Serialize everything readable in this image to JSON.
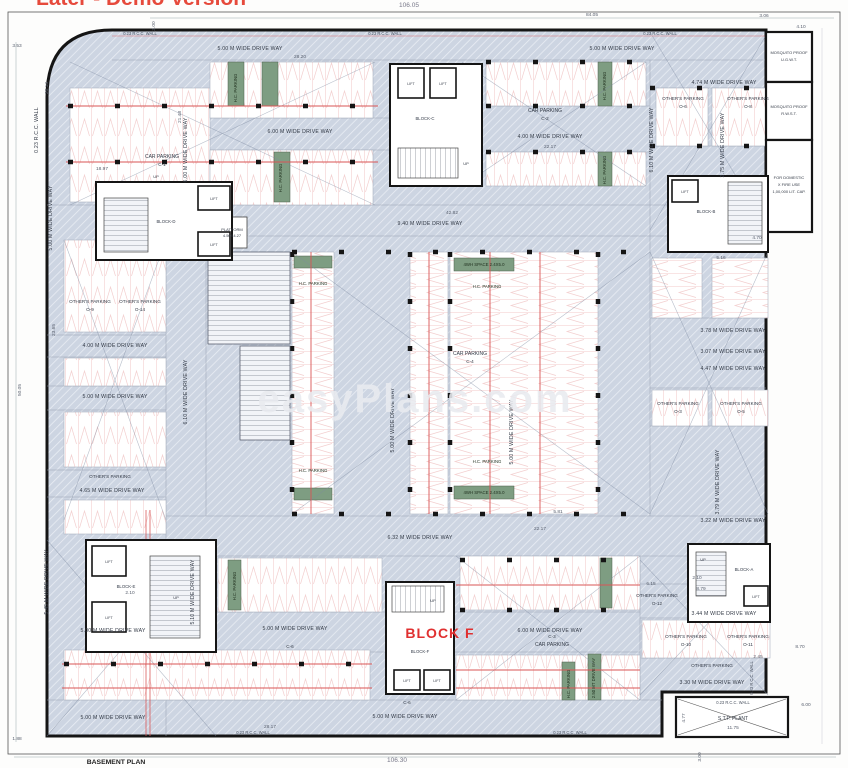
{
  "watermarks": {
    "top_cut": "Later - Demo Version",
    "site": "easyPlans.com"
  },
  "sheet": {
    "plan_title": "BASEMENT PLAN",
    "overall_top": "106.05",
    "overall_bottom": "106.30"
  },
  "strings": {
    "hc_parking": "H.C. PARKING",
    "others_parking": "OTHER'S PARKING",
    "car_parking": "CAR PARKING",
    "lift": "LIFT",
    "up": "UP",
    "rcc_wall": "0.23 R.C.C. WALL",
    "dw_500": "5.00 M WIDE DRIVE WAY",
    "dw_600": "6.00 M WIDE DRIVE WAY",
    "dw_400": "4.00 M WIDE DRIVE WAY",
    "dw_940": "9.40 M WIDE DRIVE WAY",
    "dw_474": "4.74 M WIDE DRIVE WAY",
    "dw_465": "4.65 M WIDE DRIVE WAY",
    "dw_632": "6.32 M WIDE DRIVE WAY",
    "dw_344": "3.44 M WIDE DRIVE WAY",
    "dw_330": "3.30 M WIDE DRIVE WAY",
    "dw_378": "3.78 M WIDE DRIVE WAY",
    "dw_307": "3.07 M WIDE DRIVE WAY",
    "dw_447": "4.47 M WIDE DRIVE WAY",
    "dw_322": "3.22 M WIDE DRIVE WAY",
    "dw_610": "6.10 M WIDE DRIVE WAY",
    "dw_275": "2.75 M WIDE DRIVE WAY",
    "dw_545": "5.45 M WIDE DRIVE WAY",
    "dw_510": "5.10 M WIDE DRIVE WAY",
    "dw_379": "3.79 M WIDE DRIVE WAY",
    "dw_250": "2.50 MT DRIVE WAY"
  },
  "codes": {
    "c1": "C-1",
    "c2": "C-2",
    "c3": "C-3",
    "c4": "C-4",
    "c6": "C-6",
    "o3": "O-3",
    "o5": "O-5",
    "o6": "O-6",
    "o8": "O-8",
    "o9": "O-9",
    "o10": "O-10",
    "o11": "O-11",
    "o12": "O-12",
    "o14": "O-14"
  },
  "blocks": {
    "a": "BLOCK-A",
    "b": "BLOCK-B",
    "c": "BLOCK-C",
    "d": "BLOCK-D",
    "e": "BLOCK-E",
    "f": "BLOCK-F",
    "f_big": "BLOCK F"
  },
  "rooms": {
    "platform1": "PLATFORM",
    "platform2": "4.50X4.27",
    "hc_space": "4WH SPACE 2.4X5.0"
  },
  "tanks": {
    "t1a": "MOSQUITO PROOF",
    "t1b": "U.G.W.T.",
    "t2a": "MOSQUITO PROOF",
    "t2b": "R.W.S.T.",
    "t3a": "FOR DOMESTIC",
    "t3b": "X FIRE USE",
    "t3c": "1,00,000 LIT. CAP."
  },
  "stp": {
    "name": "S.T.P. PLANT",
    "width": "11.75",
    "height": "4.77"
  },
  "dims": {
    "w8405": "84.05",
    "d2013": "20.13",
    "d2148": "21.48",
    "d2217": "22.17",
    "d4282": "42.82",
    "d2365": "23.65",
    "d1897": "18.97",
    "d2820": "28.20",
    "d2817": "28.17",
    "d879": "8.79",
    "d870": "8.70",
    "d600": "6.00",
    "d615": "6.15",
    "d581": "5.81",
    "d353": "3.53",
    "d300": "3.00",
    "d306": "3.06",
    "d410": "4.10",
    "d470": "4.70",
    "d516": "5.16",
    "d245": "2.45",
    "d210": "2.10",
    "d5005": "50.05",
    "d188": "1.88"
  }
}
